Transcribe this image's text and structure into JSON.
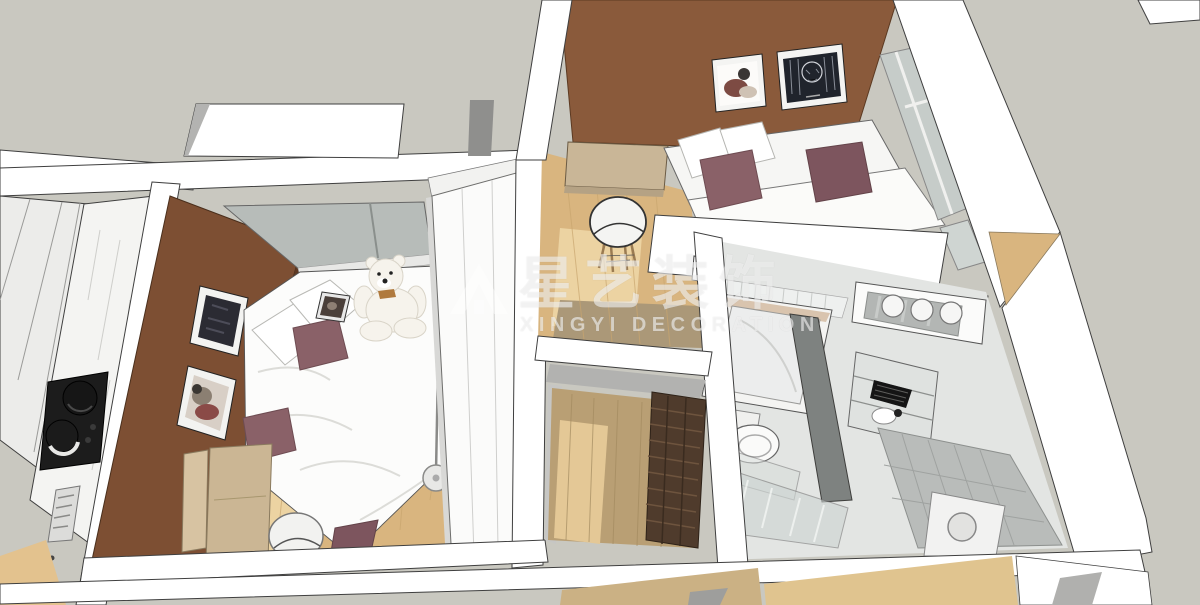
{
  "scene": {
    "type": "3d-interior-render",
    "view": "axonometric cutaway dollhouse view of a small apartment, seen obliquely from above",
    "style": "SketchUp-style render: white sectioned walls with dark edges on a flat warm-gray backdrop"
  },
  "watermark": {
    "logo_icon": "xingyi-house-logo",
    "brand_cn": "星艺装饰",
    "brand_en": "XINGYI DECORATION",
    "color": "#ffffff",
    "opacity": 0.55
  },
  "rooms": [
    {
      "name": "kitchen",
      "position": "far left strip",
      "objects": [
        "white cabinet panels",
        "marble countertop",
        "black gas cooktop",
        "two black pots",
        "tray"
      ]
    },
    {
      "name": "bedroom",
      "position": "center-left",
      "objects": [
        "brown accent wall",
        "framed dark artwork",
        "framed abstract artwork",
        "window",
        "double bed with white duvet",
        "white pillows",
        "three mauve pillows",
        "white teddy bear",
        "tablet on bed",
        "white wardrobe",
        "tan dresser panels",
        "white chair",
        "floor lamp",
        "light wood floor"
      ]
    },
    {
      "name": "living-room",
      "position": "top-right",
      "objects": [
        "brown accent wall",
        "framed figure artwork",
        "framed dark portrait artwork",
        "white sofa",
        "two mauve pillows",
        "white cushions",
        "white coffee table",
        "tan desk",
        "white shell chair with wood legs",
        "balcony window",
        "wood floor"
      ]
    },
    {
      "name": "hallway-entry",
      "position": "center",
      "objects": [
        "wood floor",
        "dark brown slatted shoe shelf",
        "gray wall bands"
      ]
    },
    {
      "name": "bathroom",
      "position": "right",
      "objects": [
        "white tiled wall",
        "bathtub",
        "toilet",
        "dark partition frame",
        "glass shower partition",
        "storage shelf with black basket",
        "white basin",
        "gray tiled wall",
        "washing machine",
        "vanity counter with three round basins"
      ]
    }
  ],
  "palette": {
    "backdrop": "#c9c8c0",
    "wall_white": "#ffffff",
    "wall_edge": "#3f3f3f",
    "wall_shade": "#b3b3b1",
    "bedroom_wall_brown": "#7d4f33",
    "living_wall_brown": "#8a5a3b",
    "wood_floor": "#d9b57f",
    "wood_light": "#ecd3a2",
    "wood_shaded": "#ab9878",
    "hall_wood": "#b99f74",
    "mauve_pillow": "#8a6168",
    "mauve_pillow_dark": "#7d555e",
    "bed_white": "#fcfcfb",
    "marble": "#f4f4f2",
    "cooktop_black": "#1c1c1c",
    "desk_tan": "#c9b697",
    "dresser_tan": "#cbb694",
    "wardrobe_white": "#fbfbfa",
    "teddy_white": "#f6f3ec",
    "glass_green": "#c6ccc9",
    "tile_gray": "#b9bcba",
    "shelf_dark_brown": "#4f3b2c",
    "art_dark": "#20242c"
  }
}
